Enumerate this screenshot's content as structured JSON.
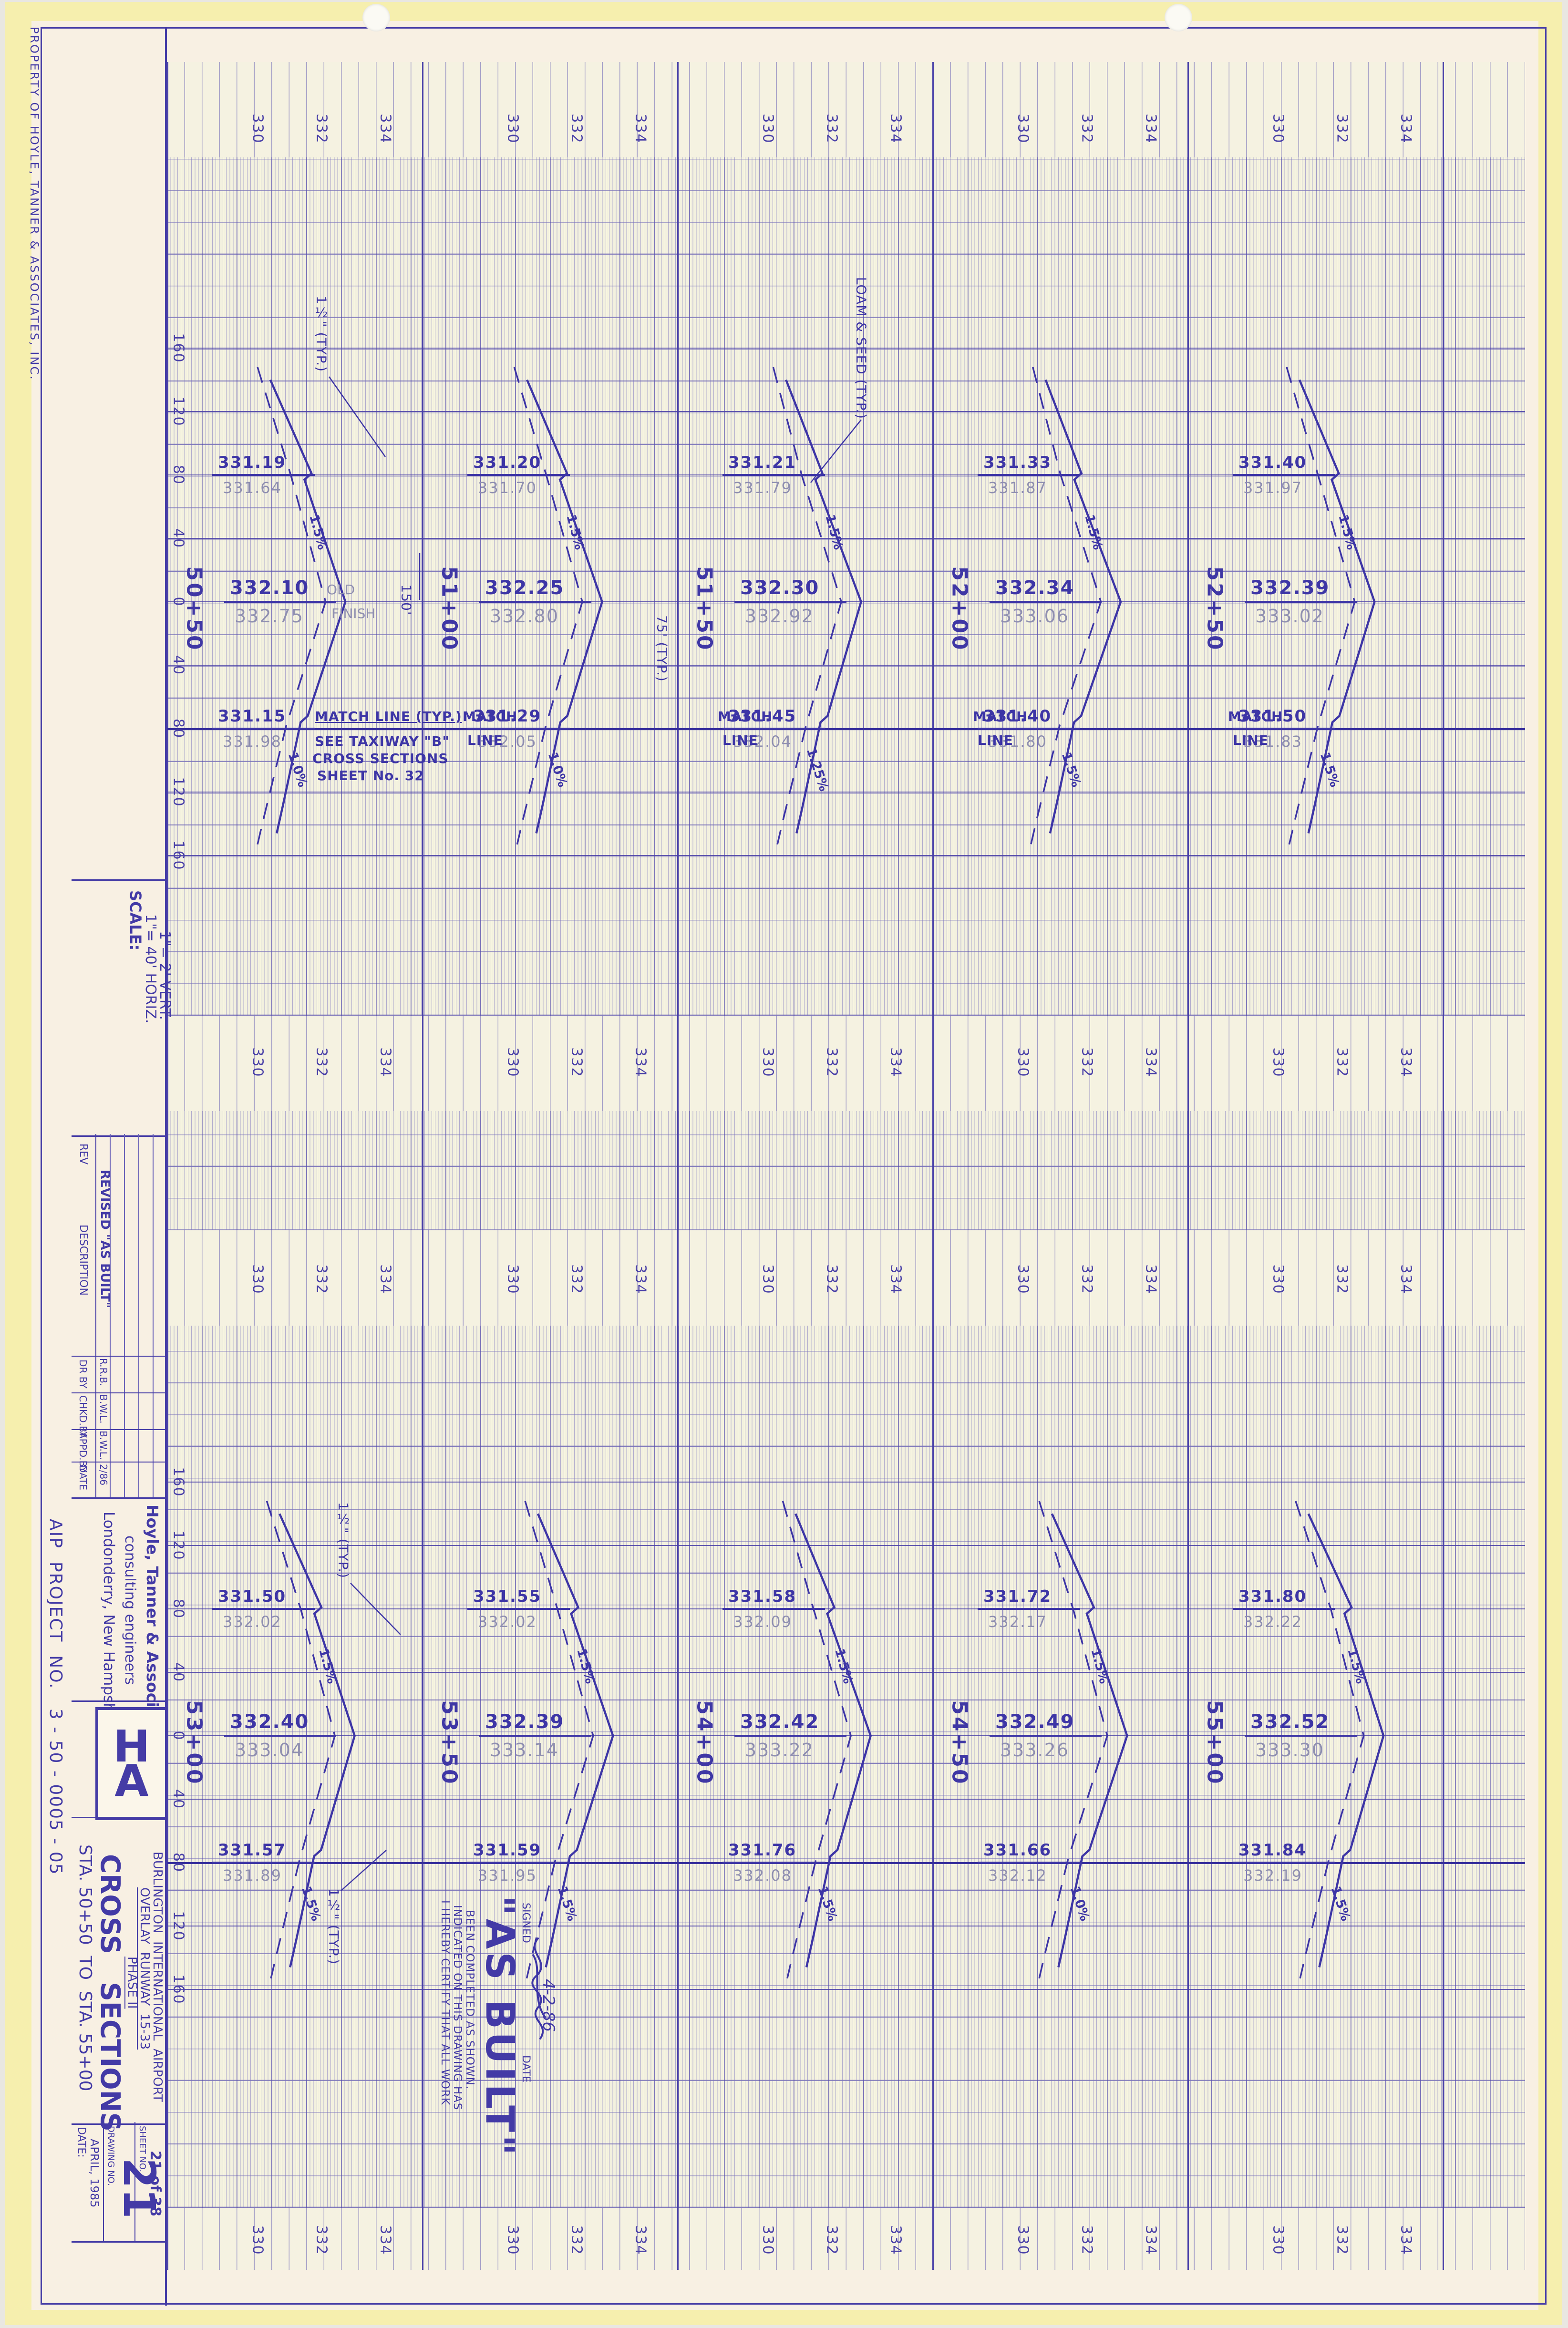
{
  "sheet": {
    "property_note": "PROPERTY OF HOYLE, TANNER & ASSOCIATES, INC.",
    "scale_block": {
      "title": "SCALE:",
      "horiz": "1\"= 40' HORIZ.",
      "vert": "1\"= 2' VERT."
    },
    "revision_table": {
      "headers": [
        "REV",
        "DESCRIPTION",
        "DR BY",
        "CHKD.BY",
        "APPD.BY",
        "DATE"
      ],
      "entry": {
        "description": "REVISED \"AS BUILT\"",
        "dr_by": "R.R.B.",
        "chkd_by": "B.W.L.",
        "appd_by": "B.W.L.",
        "date": "2/86"
      }
    },
    "firm": {
      "name": "Hoyle, Tanner & Associates, Inc.",
      "tagline": "consulting engineers",
      "location": "Londonderry, New Hampshire"
    },
    "aip_project": "AIP  PROJECT  NO.   3 - 50 - 0005 - 05",
    "logo_letters": [
      "H",
      "T",
      "A"
    ],
    "project": {
      "line1": "BURLINGTON  INTERNATIONAL  AIRPORT",
      "line2": "OVERLAY  RUNWAY  15-33",
      "line3": "PHASE II"
    },
    "title": {
      "line1": "CROSS   SECTIONS",
      "line2": "STA. 50+50  TO  STA. 55+00"
    },
    "sheet_block": {
      "date_label": "DATE:",
      "date": "APRIL, 1985",
      "drawing_no_label": "DRAWING NO.",
      "drawing_no": "21",
      "sheet_no_label": "SHEET NO.",
      "sheet_no": "21 of 38"
    },
    "as_built": {
      "big": "\"AS BUILT\"",
      "cert_lines": [
        "I HEREBY CERTIFY THAT ALL WORK",
        "INDICATED ON THIS DRAWING HAS",
        "BEEN COMPLETED AS SHOWN."
      ],
      "signed_label": "SIGNED",
      "date_label": "DATE",
      "date_value": "4-2-86"
    }
  },
  "grid": {
    "elevation_labels": [
      "330",
      "332",
      "334"
    ],
    "offset_labels": [
      "160",
      "120",
      "80",
      "40",
      "0",
      "40",
      "80",
      "120",
      "160"
    ]
  },
  "notes": {
    "match_note": [
      "MATCH LINE (TYP.)",
      "SEE TAXIWAY \"B\"",
      "CROSS SECTIONS",
      "SHEET No. 32"
    ],
    "match_label": [
      "MATCH",
      "LINE"
    ],
    "loam": "LOAM & SEED (TYP.)",
    "half_width": "75' (TYP.)",
    "dim_150": "150'",
    "pave": "1½\" (TYP.)",
    "cl_note": [
      "OLD",
      "FINISH"
    ]
  },
  "halves": [
    {
      "stations": [
        {
          "label": "50+50",
          "top": [
            "331.19",
            "331.64"
          ],
          "cl": [
            "332.10",
            "332.75"
          ],
          "bottom": [
            "331.15",
            "331.98"
          ],
          "upper_slope": "1.5%",
          "lower_slope": "1.0%",
          "has_cl_note": true,
          "has_match_note": true
        },
        {
          "label": "51+00",
          "top": [
            "331.20",
            "331.70"
          ],
          "cl": [
            "332.25",
            "332.80"
          ],
          "bottom": [
            "331.29",
            "332.05"
          ],
          "upper_slope": "1.5%",
          "lower_slope": "1.0%",
          "match": true
        },
        {
          "label": "51+50",
          "top": [
            "331.21",
            "331.79"
          ],
          "cl": [
            "332.30",
            "332.92"
          ],
          "bottom": [
            "331.45",
            "332.04"
          ],
          "upper_slope": "1.5%",
          "lower_slope": "1.25%",
          "match": true
        },
        {
          "label": "52+00",
          "top": [
            "331.33",
            "331.87"
          ],
          "cl": [
            "332.34",
            "333.06"
          ],
          "bottom": [
            "331.40",
            "331.80"
          ],
          "upper_slope": "1.5%",
          "lower_slope": "1.5%",
          "match": true
        },
        {
          "label": "52+50",
          "top": [
            "331.40",
            "331.97"
          ],
          "cl": [
            "332.39",
            "333.02"
          ],
          "bottom": [
            "331.50",
            "331.83"
          ],
          "upper_slope": "1.5%",
          "lower_slope": "1.5%",
          "match": true
        }
      ]
    },
    {
      "stations": [
        {
          "label": "53+00",
          "top": [
            "331.50",
            "332.02"
          ],
          "cl": [
            "332.40",
            "333.04"
          ],
          "bottom": [
            "331.57",
            "331.89"
          ],
          "upper_slope": "1.5%",
          "lower_slope": "1.5%"
        },
        {
          "label": "53+50",
          "top": [
            "331.55",
            "332.02"
          ],
          "cl": [
            "332.39",
            "333.14"
          ],
          "bottom": [
            "331.59",
            "331.95"
          ],
          "upper_slope": "1.5%",
          "lower_slope": "1.5%"
        },
        {
          "label": "54+00",
          "top": [
            "331.58",
            "332.09"
          ],
          "cl": [
            "332.42",
            "333.22"
          ],
          "bottom": [
            "331.76",
            "332.08"
          ],
          "upper_slope": "1.5%",
          "lower_slope": "1.5%"
        },
        {
          "label": "54+50",
          "top": [
            "331.72",
            "332.17"
          ],
          "cl": [
            "332.49",
            "333.26"
          ],
          "bottom": [
            "331.66",
            "332.12"
          ],
          "upper_slope": "1.5%",
          "lower_slope": "1.0%"
        },
        {
          "label": "55+00",
          "top": [
            "331.80",
            "332.22"
          ],
          "cl": [
            "332.52",
            "333.30"
          ],
          "bottom": [
            "331.84",
            "332.19"
          ],
          "upper_slope": "1.5%",
          "lower_slope": "1.5%"
        }
      ]
    }
  ]
}
